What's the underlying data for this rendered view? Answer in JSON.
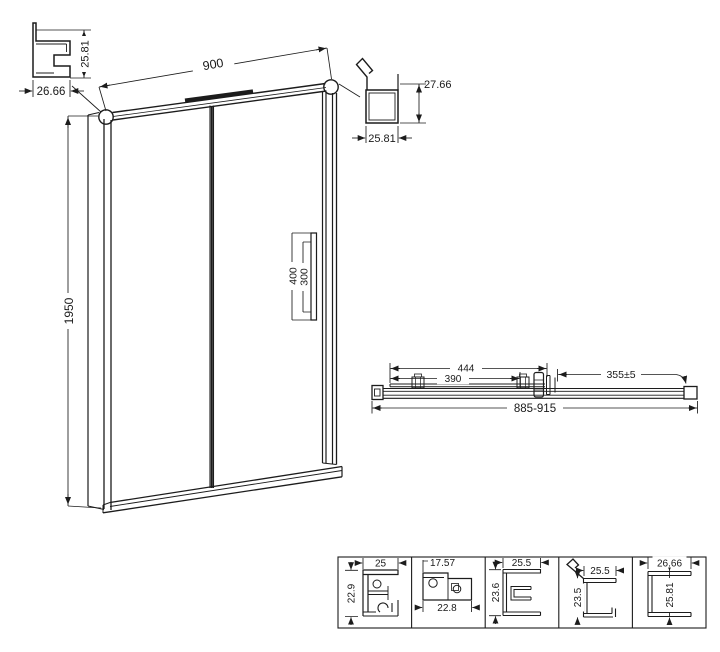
{
  "drawing": {
    "wall_profile_detail": {
      "width": "26.66",
      "height": "25.81"
    },
    "door_elevation": {
      "width": "900",
      "height": "1950",
      "handle_length": "400",
      "handle_hole_spacing": "300"
    },
    "top_rail_profile_detail": {
      "height": "27.66",
      "width": "25.81"
    },
    "plan_view": {
      "glass_width": "444",
      "inner_width": "390",
      "side_clearance": "355±5",
      "overall_width": "885-915"
    },
    "profile_sections": [
      {
        "width": "25",
        "height": "22.9"
      },
      {
        "width": "17.57",
        "height": "22.8"
      },
      {
        "width": "25.5",
        "height": "23.6"
      },
      {
        "width": "25.5",
        "height": "23.5"
      },
      {
        "width": "26.66",
        "height": "25.81"
      }
    ]
  }
}
